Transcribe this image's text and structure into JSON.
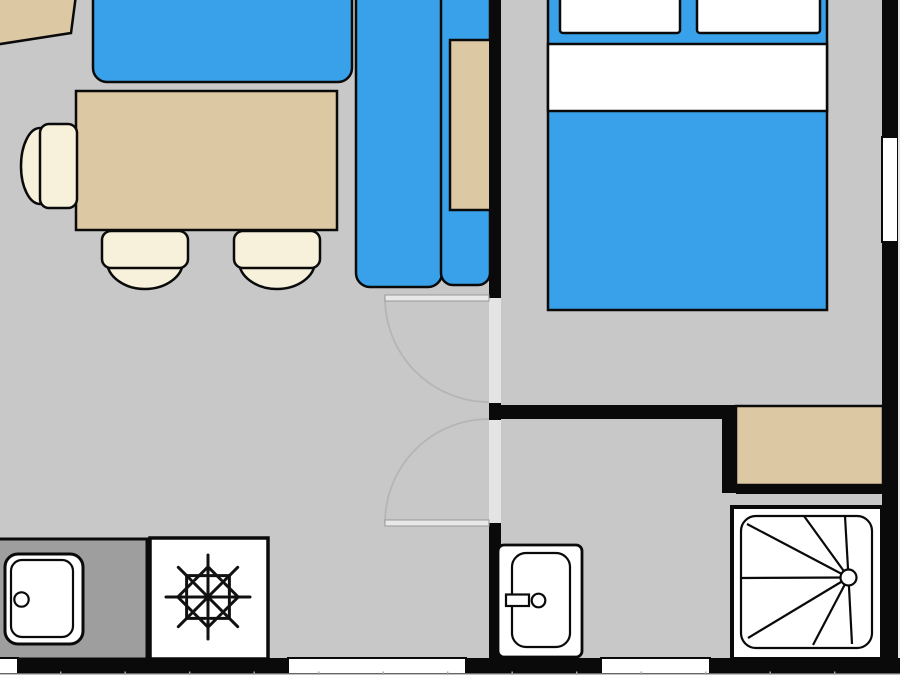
{
  "meta": {
    "kind": "floor-plan",
    "visible_text": "",
    "canvas": {
      "width": 900,
      "height": 675
    }
  },
  "palette": {
    "floor": "#c8c8c9",
    "wall": "#0a0a0a",
    "upholstery_blue": "#38a1e9",
    "wood_tan": "#dcc8a2",
    "chair_cream": "#f7f1db",
    "counter_gray": "#9e9e9e",
    "fixture_white": "#ffffff",
    "door_gap": "#e4e4e4",
    "door_leaf": "#e8e8e8",
    "swing_arc": "#b5b5b5",
    "outline": "#0a0a0a"
  },
  "icons": [
    {
      "name": "snowflake-icon",
      "meaning": "freezer/refrigerator"
    },
    {
      "name": "shower-spray-icon",
      "meaning": "shower head spray"
    },
    {
      "name": "door-swing-icon",
      "meaning": "door opening arc"
    }
  ],
  "plan": {
    "shapes": [
      {
        "name": "floor",
        "type": "rect",
        "x": -1,
        "y": -1,
        "w": 902,
        "h": 677,
        "fill": "#c8c8c9"
      },
      {
        "name": "corner-table",
        "type": "polygon",
        "points": "-6,-6 76,-5 71,33 -6,45",
        "fill": "#dcc8a2",
        "stroke": "#0a0a0a",
        "sw": 2.5
      },
      {
        "name": "sofa-top",
        "type": "rect",
        "x": 93,
        "y": -16,
        "w": 259,
        "h": 98,
        "rx": 14,
        "fill": "#38a1e9",
        "stroke": "#0a0a0a",
        "sw": 2.5
      },
      {
        "name": "sofa-chaise-seat",
        "type": "rect",
        "x": 356,
        "y": -16,
        "w": 86,
        "h": 303,
        "rx": 14,
        "fill": "#38a1e9",
        "stroke": "#0a0a0a",
        "sw": 2.5
      },
      {
        "name": "sofa-chaise-back",
        "type": "rect",
        "x": 441,
        "y": -16,
        "w": 49,
        "h": 301,
        "rx": 12,
        "fill": "#38a1e9",
        "stroke": "#0a0a0a",
        "sw": 2.5
      },
      {
        "name": "sofa-side-table",
        "type": "rect",
        "x": 450,
        "y": 40,
        "w": 46,
        "h": 170,
        "fill": "#dcc8a2",
        "stroke": "#0a0a0a",
        "sw": 2.5
      },
      {
        "name": "dining-table",
        "type": "rect",
        "x": 76,
        "y": 91,
        "w": 261,
        "h": 139,
        "fill": "#dcc8a2",
        "stroke": "#0a0a0a",
        "sw": 2.5
      },
      {
        "name": "chair-head-back",
        "type": "ellipse",
        "cx": 40,
        "cy": 166,
        "rx": 19,
        "ry": 38,
        "fill": "#f7f1db",
        "stroke": "#0a0a0a",
        "sw": 2.5
      },
      {
        "name": "chair-head-seat",
        "type": "rect",
        "x": 40,
        "y": 124,
        "w": 37,
        "h": 84,
        "rx": 9,
        "fill": "#f7f1db",
        "stroke": "#0a0a0a",
        "sw": 2.5
      },
      {
        "name": "chair-1-back",
        "type": "ellipse",
        "cx": 145,
        "cy": 261,
        "rx": 38,
        "ry": 28,
        "fill": "#f7f1db",
        "stroke": "#0a0a0a",
        "sw": 2.5
      },
      {
        "name": "chair-1-seat",
        "type": "rect",
        "x": 102,
        "y": 231,
        "w": 86,
        "h": 37,
        "rx": 9,
        "fill": "#f7f1db",
        "stroke": "#0a0a0a",
        "sw": 2.5
      },
      {
        "name": "chair-2-back",
        "type": "ellipse",
        "cx": 277,
        "cy": 261,
        "rx": 38,
        "ry": 28,
        "fill": "#f7f1db",
        "stroke": "#0a0a0a",
        "sw": 2.5
      },
      {
        "name": "chair-2-seat",
        "type": "rect",
        "x": 234,
        "y": 231,
        "w": 86,
        "h": 37,
        "rx": 9,
        "fill": "#f7f1db",
        "stroke": "#0a0a0a",
        "sw": 2.5
      },
      {
        "name": "bed",
        "type": "rect",
        "x": 548,
        "y": -10,
        "w": 279,
        "h": 320,
        "fill": "#38a1e9",
        "stroke": "#0a0a0a",
        "sw": 2.5
      },
      {
        "name": "bed-pillow-left",
        "type": "rect",
        "x": 560,
        "y": -8,
        "w": 120,
        "h": 41,
        "rx": 3,
        "fill": "#ffffff",
        "stroke": "#0a0a0a",
        "sw": 2.5
      },
      {
        "name": "bed-pillow-right",
        "type": "rect",
        "x": 697,
        "y": -8,
        "w": 123,
        "h": 41,
        "rx": 3,
        "fill": "#ffffff",
        "stroke": "#0a0a0a",
        "sw": 2.5
      },
      {
        "name": "bed-sheet",
        "type": "rect",
        "x": 548,
        "y": 44,
        "w": 279,
        "h": 67,
        "fill": "#ffffff",
        "stroke": "#0a0a0a",
        "sw": 2.5
      },
      {
        "name": "wall-center-upper",
        "type": "rect",
        "x": 489,
        "y": -4,
        "w": 12,
        "h": 302,
        "fill": "#0a0a0a"
      },
      {
        "name": "door-gap-upper",
        "type": "rect",
        "x": 489,
        "y": 298,
        "w": 12,
        "h": 105,
        "fill": "#e4e4e4"
      },
      {
        "name": "wall-center-stub",
        "type": "rect",
        "x": 489,
        "y": 403,
        "w": 12,
        "h": 17,
        "fill": "#0a0a0a"
      },
      {
        "name": "door-gap-lower",
        "type": "rect",
        "x": 489,
        "y": 420,
        "w": 12,
        "h": 103,
        "fill": "#e4e4e4"
      },
      {
        "name": "wall-center-lower",
        "type": "rect",
        "x": 489,
        "y": 523,
        "w": 12,
        "h": 137,
        "fill": "#0a0a0a"
      },
      {
        "name": "wall-bath-top",
        "type": "rect",
        "x": 498,
        "y": 405,
        "w": 238,
        "h": 14,
        "fill": "#0a0a0a"
      },
      {
        "name": "wall-bath-jog",
        "type": "rect",
        "x": 722,
        "y": 405,
        "w": 14,
        "h": 88,
        "fill": "#0a0a0a"
      },
      {
        "name": "wall-bath-lower",
        "type": "rect",
        "x": 736,
        "y": 481,
        "w": 162,
        "h": 13,
        "fill": "#0a0a0a"
      },
      {
        "name": "closet-counter",
        "type": "rect",
        "x": 736,
        "y": 406,
        "w": 147,
        "h": 79,
        "fill": "#dcc8a2",
        "stroke": "#0a0a0a",
        "sw": 2.5
      },
      {
        "name": "wall-right-upper",
        "type": "rect",
        "x": 882,
        "y": -4,
        "w": 16,
        "h": 141,
        "fill": "#0a0a0a"
      },
      {
        "name": "window-right",
        "type": "rect",
        "x": 882,
        "y": 137,
        "w": 16,
        "h": 105,
        "fill": "#ffffff",
        "stroke": "#0a0a0a",
        "sw": 2
      },
      {
        "name": "wall-right-lower",
        "type": "rect",
        "x": 882,
        "y": 242,
        "w": 16,
        "h": 434,
        "fill": "#0a0a0a"
      },
      {
        "name": "right-edge-strip",
        "type": "rect",
        "x": 898,
        "y": -2,
        "w": 3,
        "h": 679,
        "fill": "#e6e6e6"
      },
      {
        "name": "door-swing-upper",
        "type": "path",
        "d": "M 385 298 A 104 104 0 0 0 489 402",
        "stroke": "#b5b5b5",
        "sw": 1.8
      },
      {
        "name": "door-leaf-upper",
        "type": "rect",
        "x": 385,
        "y": 295,
        "w": 104,
        "h": 6,
        "fill": "#e8e8e8",
        "stroke": "#999999",
        "sw": 1
      },
      {
        "name": "door-swing-lower",
        "type": "path",
        "d": "M 385 523 A 104 104 0 0 1 489 419",
        "stroke": "#b5b5b5",
        "sw": 1.8
      },
      {
        "name": "door-leaf-lower",
        "type": "rect",
        "x": 385,
        "y": 520,
        "w": 104,
        "h": 6,
        "fill": "#e8e8e8",
        "stroke": "#999999",
        "sw": 1
      },
      {
        "name": "kitchen-counter",
        "type": "rect",
        "x": -4,
        "y": 539,
        "w": 151,
        "h": 120,
        "fill": "#9e9e9e",
        "stroke": "#0a0a0a",
        "sw": 3
      },
      {
        "name": "sink-outer",
        "type": "rect",
        "x": 5,
        "y": 554,
        "w": 78,
        "h": 90,
        "rx": 13,
        "fill": "#ffffff",
        "stroke": "#0a0a0a",
        "sw": 3
      },
      {
        "name": "sink-basin",
        "type": "rect",
        "x": 11,
        "y": 560,
        "w": 62,
        "h": 77,
        "rx": 11,
        "fill": "#ffffff",
        "stroke": "#0a0a0a",
        "sw": 2.2
      },
      {
        "name": "sink-faucet",
        "type": "circle",
        "cx": 21.5,
        "cy": 599.5,
        "r": 7.2,
        "fill": "#ffffff",
        "stroke": "#0a0a0a",
        "sw": 2.2
      },
      {
        "name": "fridge",
        "type": "rect",
        "x": 150,
        "y": 538,
        "w": 118,
        "h": 121,
        "fill": "#ffffff",
        "stroke": "#0a0a0a",
        "sw": 3.5
      },
      {
        "name": "snowflake-icon",
        "type": "snowflake",
        "cx": 208,
        "cy": 597,
        "r": 42,
        "sw": 3,
        "color": "#111111"
      },
      {
        "name": "window-bottom-left",
        "type": "rect",
        "x": -3,
        "y": 658,
        "w": 21,
        "h": 16,
        "fill": "#ffffff",
        "stroke": "#0a0a0a",
        "sw": 2
      },
      {
        "name": "wall-bottom-1",
        "type": "rect",
        "x": 17,
        "y": 658,
        "w": 271,
        "h": 16,
        "fill": "#0a0a0a"
      },
      {
        "name": "window-bottom-2",
        "type": "rect",
        "x": 288,
        "y": 658,
        "w": 178,
        "h": 16,
        "fill": "#ffffff",
        "stroke": "#0a0a0a",
        "sw": 2
      },
      {
        "name": "wall-bottom-2",
        "type": "rect",
        "x": 466,
        "y": 658,
        "w": 135,
        "h": 16,
        "fill": "#0a0a0a"
      },
      {
        "name": "window-bottom-3",
        "type": "rect",
        "x": 601,
        "y": 658,
        "w": 109,
        "h": 16,
        "fill": "#ffffff",
        "stroke": "#0a0a0a",
        "sw": 2
      },
      {
        "name": "wall-bottom-3",
        "type": "rect",
        "x": 710,
        "y": 658,
        "w": 191,
        "h": 16,
        "fill": "#0a0a0a"
      },
      {
        "name": "bottom-edge-strip",
        "type": "rect",
        "x": 0,
        "y": 673.5,
        "w": 900,
        "h": 1.5,
        "fill": "#c2c2c2"
      },
      {
        "name": "bottom-ruler-ticks",
        "type": "ticks",
        "x0": 60,
        "x1": 893,
        "step": 64.5,
        "y": 671.5,
        "h": 4,
        "w": 1.4,
        "color": "#a8a8a8"
      },
      {
        "name": "toilet-outer",
        "type": "rect",
        "x": 498,
        "y": 545,
        "w": 84,
        "h": 112,
        "rx": 6,
        "fill": "#ffffff",
        "stroke": "#0a0a0a",
        "sw": 2.8
      },
      {
        "name": "toilet-bowl",
        "type": "rect",
        "x": 512,
        "y": 553,
        "w": 58,
        "h": 94,
        "rx": 14,
        "fill": "#ffffff",
        "stroke": "#0a0a0a",
        "sw": 2.2
      },
      {
        "name": "toilet-flush-lever",
        "type": "rect",
        "x": 506,
        "y": 594.5,
        "w": 23,
        "h": 11.5,
        "fill": "#ffffff",
        "stroke": "#0a0a0a",
        "sw": 2.2
      },
      {
        "name": "toilet-flush-button",
        "type": "circle",
        "cx": 538.5,
        "cy": 600.5,
        "r": 6.8,
        "fill": "#ffffff",
        "stroke": "#0a0a0a",
        "sw": 2.2
      },
      {
        "name": "shower-tray",
        "type": "rect",
        "x": 732,
        "y": 507,
        "w": 150,
        "h": 152,
        "fill": "#ffffff",
        "stroke": "#0a0a0a",
        "sw": 4
      },
      {
        "name": "shower-basin",
        "type": "rect",
        "x": 741,
        "y": 516,
        "w": 131,
        "h": 132,
        "rx": 15,
        "fill": "none",
        "stroke": "#0a0a0a",
        "sw": 2.2
      },
      {
        "name": "shower-spray-icon",
        "type": "rays",
        "from": [
          848.5,
          577.5
        ],
        "to": [
          [
            747,
            524
          ],
          [
            742,
            578
          ],
          [
            748,
            638
          ],
          [
            804,
            516
          ],
          [
            813,
            645
          ],
          [
            845,
            516
          ],
          [
            852,
            644
          ]
        ],
        "sw": 2.2,
        "color": "#0a0a0a"
      },
      {
        "name": "shower-drain",
        "type": "circle",
        "cx": 848.5,
        "cy": 577.5,
        "r": 8,
        "fill": "#ffffff",
        "stroke": "#0a0a0a",
        "sw": 2.2
      }
    ]
  }
}
